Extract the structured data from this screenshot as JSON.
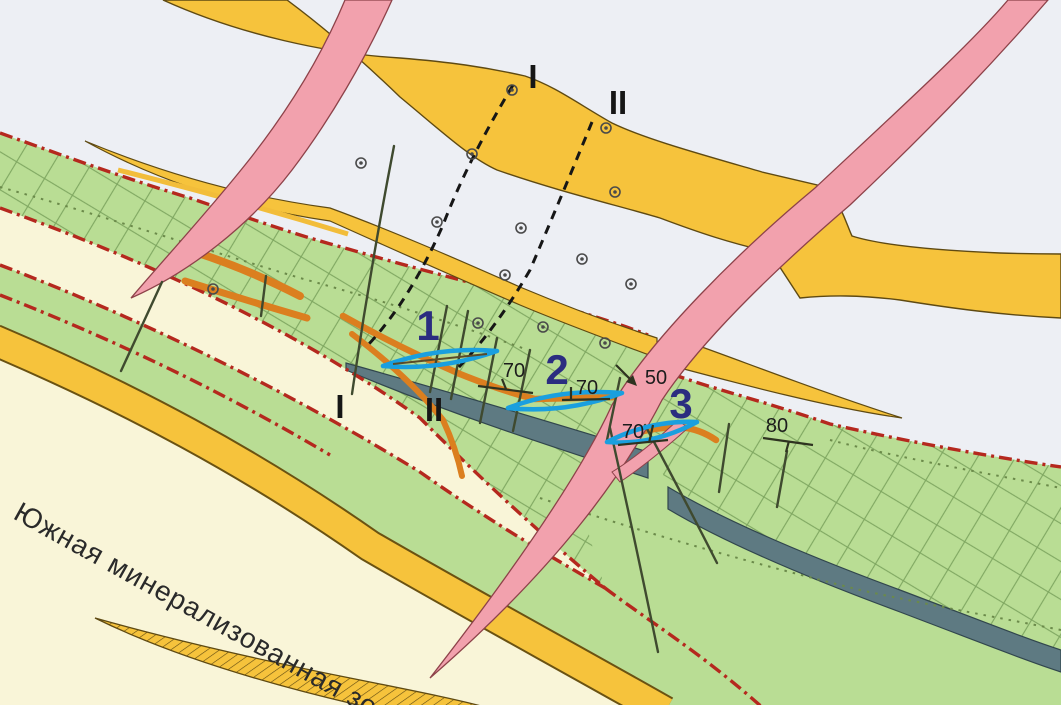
{
  "map": {
    "title": "Geological sketch map with mineralized zones",
    "labels": {
      "zone": "Южная минерализованная зона",
      "section_1": "I",
      "section_2": "II"
    },
    "ore_bodies": [
      {
        "number": "1",
        "dip": "70"
      },
      {
        "number": "2",
        "dip": "70"
      },
      {
        "number": "3",
        "dip": "70"
      }
    ],
    "measurements": {
      "fault_dip": "50",
      "east_dip": "80"
    },
    "symbols": {
      "drill_hole": "double-circle",
      "ore_block_outline": "blue-lens",
      "zone_boundary": "red-dash-dot",
      "section_line": "black-dashed"
    },
    "colors": {
      "background": "#edeff4",
      "host_green": "#b9dd94",
      "cream": "#f9f5d8",
      "yellow_band": "#f6c33c",
      "pink_dike": "#f2a1ad",
      "slate_band": "#5e7a82",
      "boundary_red": "#b5281e",
      "ore_orange": "#db7f1f",
      "block_blue": "#1a9fdf",
      "number_navy": "#2b2d80"
    }
  }
}
